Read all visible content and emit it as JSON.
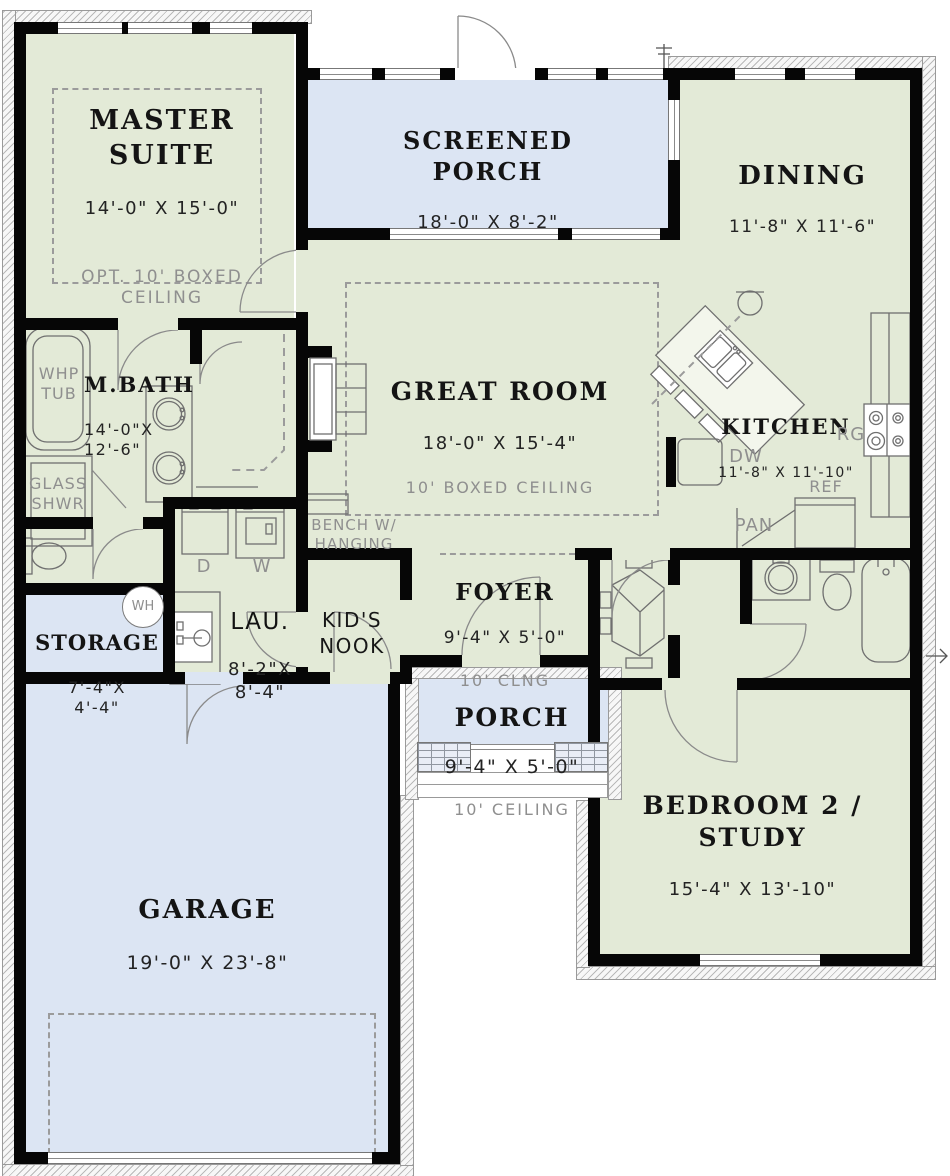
{
  "rooms": {
    "master_suite": {
      "name": "MASTER\nSUITE",
      "dims": "14'-0\" X 15'-0\"",
      "note": "OPT. 10' BOXED\nCEILING"
    },
    "screened_porch": {
      "name": "SCREENED\nPORCH",
      "dims": "18'-0\" X 8'-2\""
    },
    "dining": {
      "name": "DINING",
      "dims": "11'-8\" X 11'-6\""
    },
    "master_bath": {
      "name": "M.BATH",
      "dims": "14'-0\"X\n12'-6\""
    },
    "great_room": {
      "name": "GREAT ROOM",
      "dims": "18'-0\" X 15'-4\"",
      "note": "10' BOXED CEILING"
    },
    "kitchen": {
      "name": "KITCHEN",
      "dims": "11'-8\" X 11'-10\""
    },
    "laundry": {
      "name": "LAU.",
      "dims": "8'-2\"X\n8'-4\""
    },
    "storage": {
      "name": "STORAGE",
      "dims": "7'-4\"X\n4'-4\""
    },
    "kids_nook": {
      "name": "KID'S\nNOOK"
    },
    "foyer": {
      "name": "FOYER",
      "dims": "9'-4\" X 5'-0\"",
      "note": "10' CLNG"
    },
    "porch": {
      "name": "PORCH",
      "dims": "9'-4\" X 5'-0\"",
      "note": "10' CEILING"
    },
    "bedroom2": {
      "name": "BEDROOM 2 /\nSTUDY",
      "dims": "15'-4\" X 13'-10\""
    },
    "garage": {
      "name": "GARAGE",
      "dims": "19'-0\" X 23'-8\""
    }
  },
  "fixtures": {
    "whirlpool_tub": "WHP\nTUB",
    "glass_shower": "GLASS\nSHWR",
    "bench": "BENCH W/\nHANGING",
    "dishwasher": "DW",
    "range": "RG",
    "refrigerator": "REF",
    "pantry": "PAN",
    "dryer": "D",
    "washer": "W",
    "water_heater": "WH"
  },
  "colors": {
    "room_fill": "#e3ead7",
    "porch_garage_fill": "#dce5f3",
    "wall": "#060606",
    "dashed_line": "#9b9b9b",
    "fixture_line": "#6f6f6f"
  }
}
